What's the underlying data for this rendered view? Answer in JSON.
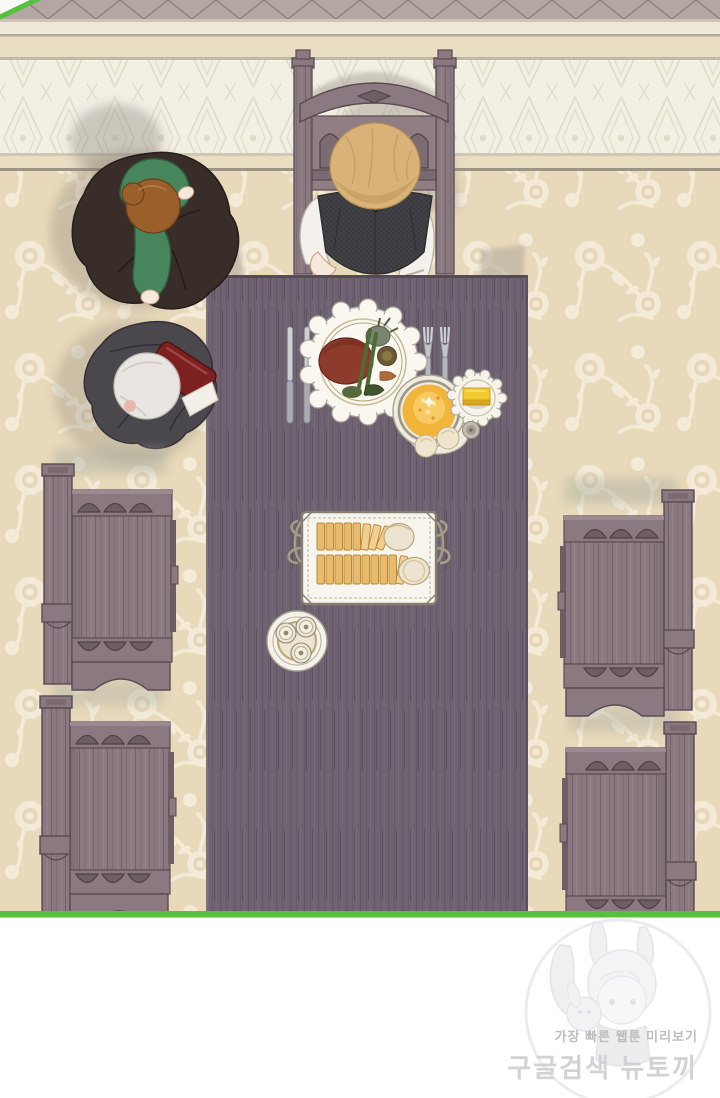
{
  "panel": {
    "type": "webtoon-panel",
    "view": "top-down dining room scene"
  },
  "watermark": {
    "line1": "가장 빠른 웹툰 미리보기",
    "line2": "구글검색 뉴토끼"
  },
  "colors": {
    "border_green": "#55c13c",
    "wall_molding": "#b3a7a3",
    "wall_band_light": "#efe8d9",
    "wall_band_cream": "#e9ddc2",
    "wallpaper_base": "#f2efe3",
    "wallpaper_motif": "#e1dcc9",
    "floor_base": "#e9d9bb",
    "floor_motif": "#f3ebd7",
    "table_wood": "#6f6271",
    "table_wood_dark": "#554b57",
    "chair_wood": "#8a7980",
    "chair_wood_dark": "#5a4b52",
    "hair_blonde": "#d8b278",
    "vest_charcoal": "#3d3d42",
    "shirt_white": "#f4f1ec",
    "skin_tone": "#f6e9dc",
    "maid_dress_green": "#47855c",
    "maid_hair_brown": "#99602c",
    "maid_skirt_brown": "#382d29",
    "butler_coat_grey": "#4a474d",
    "butler_hair_silver": "#e9e5e1",
    "wine_red": "#7d2020",
    "plate_white": "#faf7f0",
    "steak_brown": "#8d3b2b",
    "soup_yellow": "#f1b53a",
    "butter_yellow": "#f1ca2e",
    "bread_golden": "#eaba6b",
    "cutlery_silver": "#cfd0d3",
    "watermark_text_grey": "#bdbdbd",
    "watermark_text_light": "#d2d2d2",
    "footer_white": "#ffffff"
  }
}
